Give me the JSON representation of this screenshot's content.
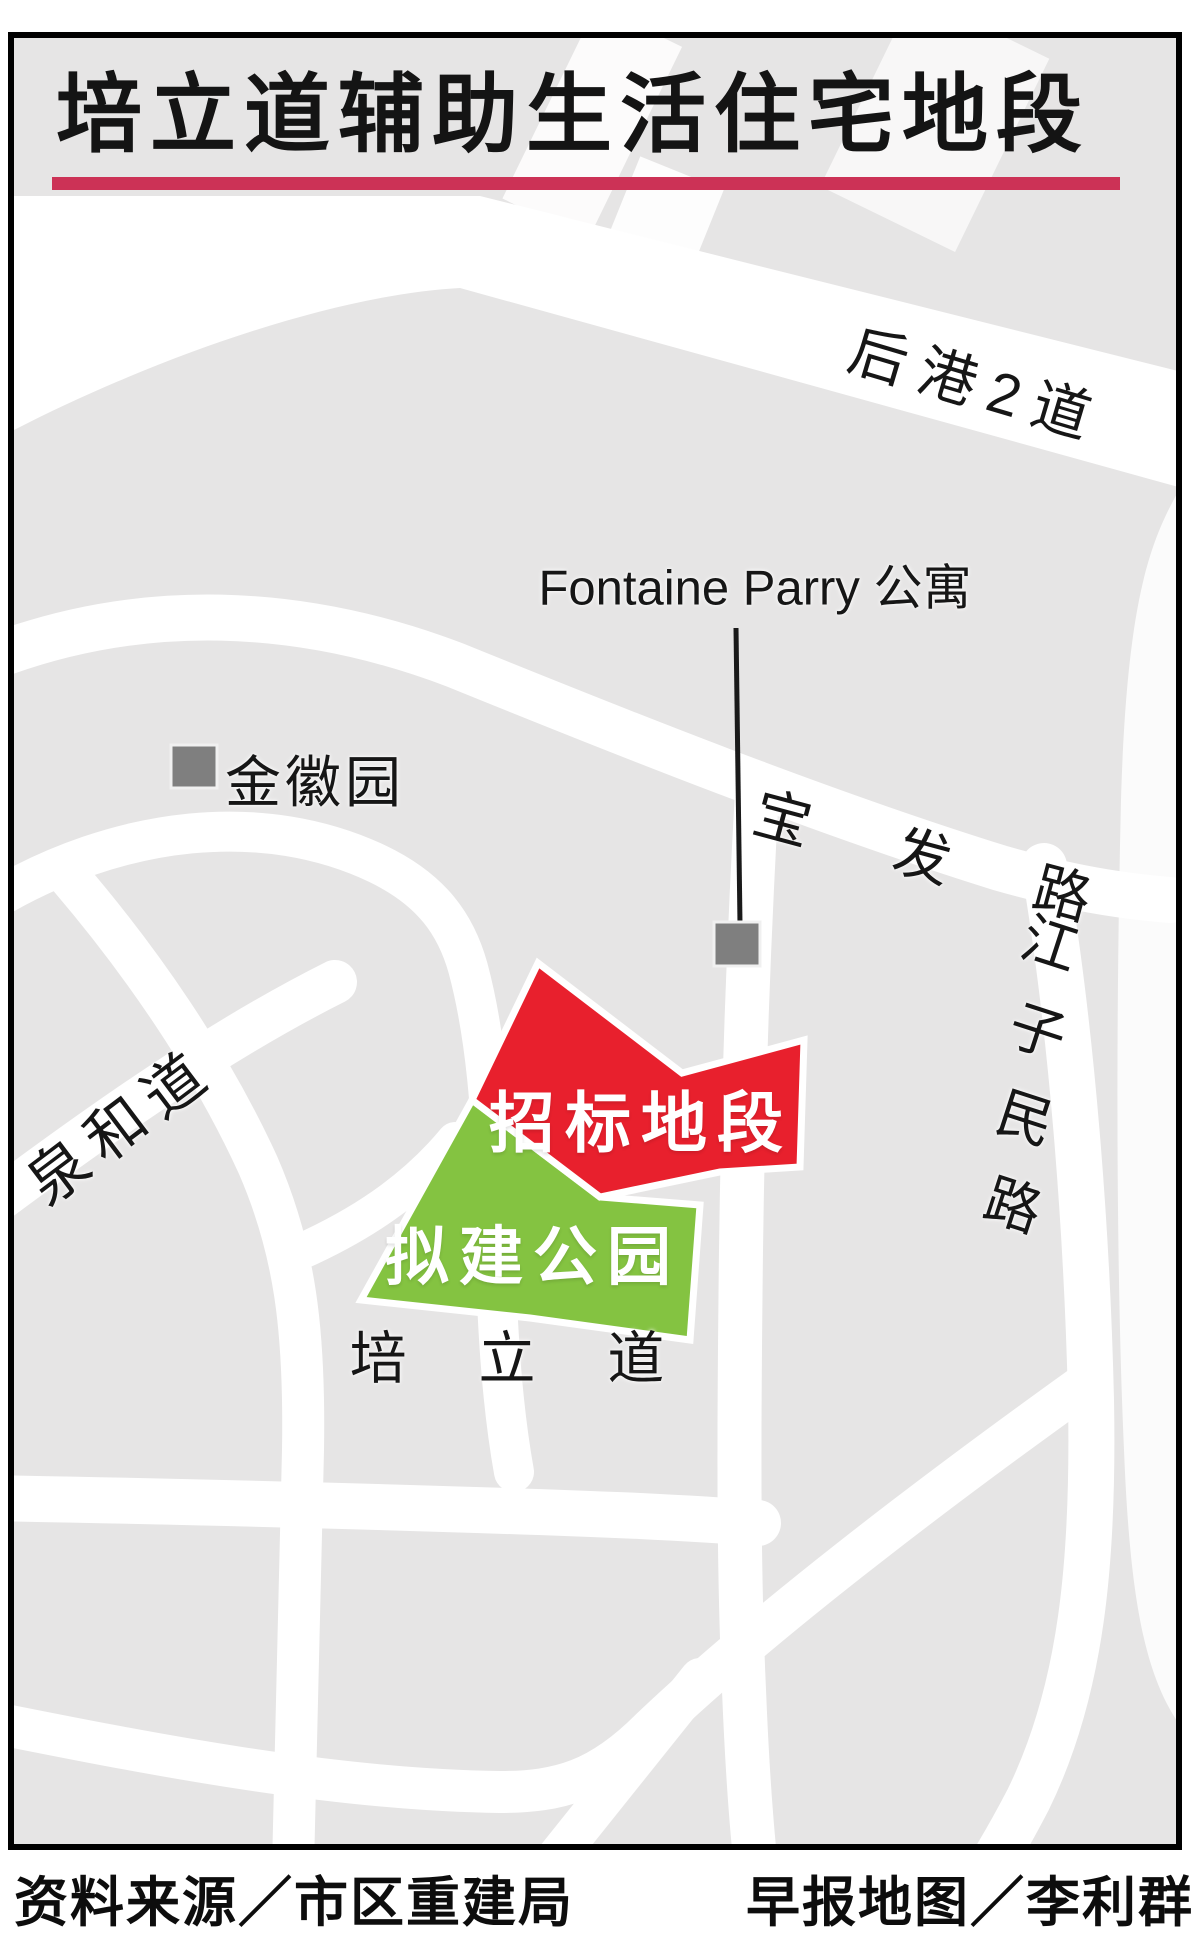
{
  "title": "培立道辅助生活住宅地段",
  "colors": {
    "underline": "#cc3256",
    "tender_red": "#e8202d",
    "park_green": "#84c341",
    "road": "#ffffff",
    "map_bg": "#e6e5e5",
    "marker": "#7f7f7f",
    "frame": "#000000"
  },
  "map": {
    "road_labels": {
      "hougang2": "后港2道",
      "baofa": "宝 发 路",
      "jiangzimin_chars": [
        "江",
        "子",
        "民",
        "路"
      ],
      "quanhe": "泉和道",
      "peili": "培 立 道"
    },
    "poi": {
      "fontaine": "Fontaine Parry 公寓",
      "jinhui": "金徽园"
    },
    "zones": {
      "tender": "招标地段",
      "park": "拟建公园"
    }
  },
  "footer": {
    "source": "资料来源／市区重建局",
    "credit": "早报地图／李利群"
  }
}
